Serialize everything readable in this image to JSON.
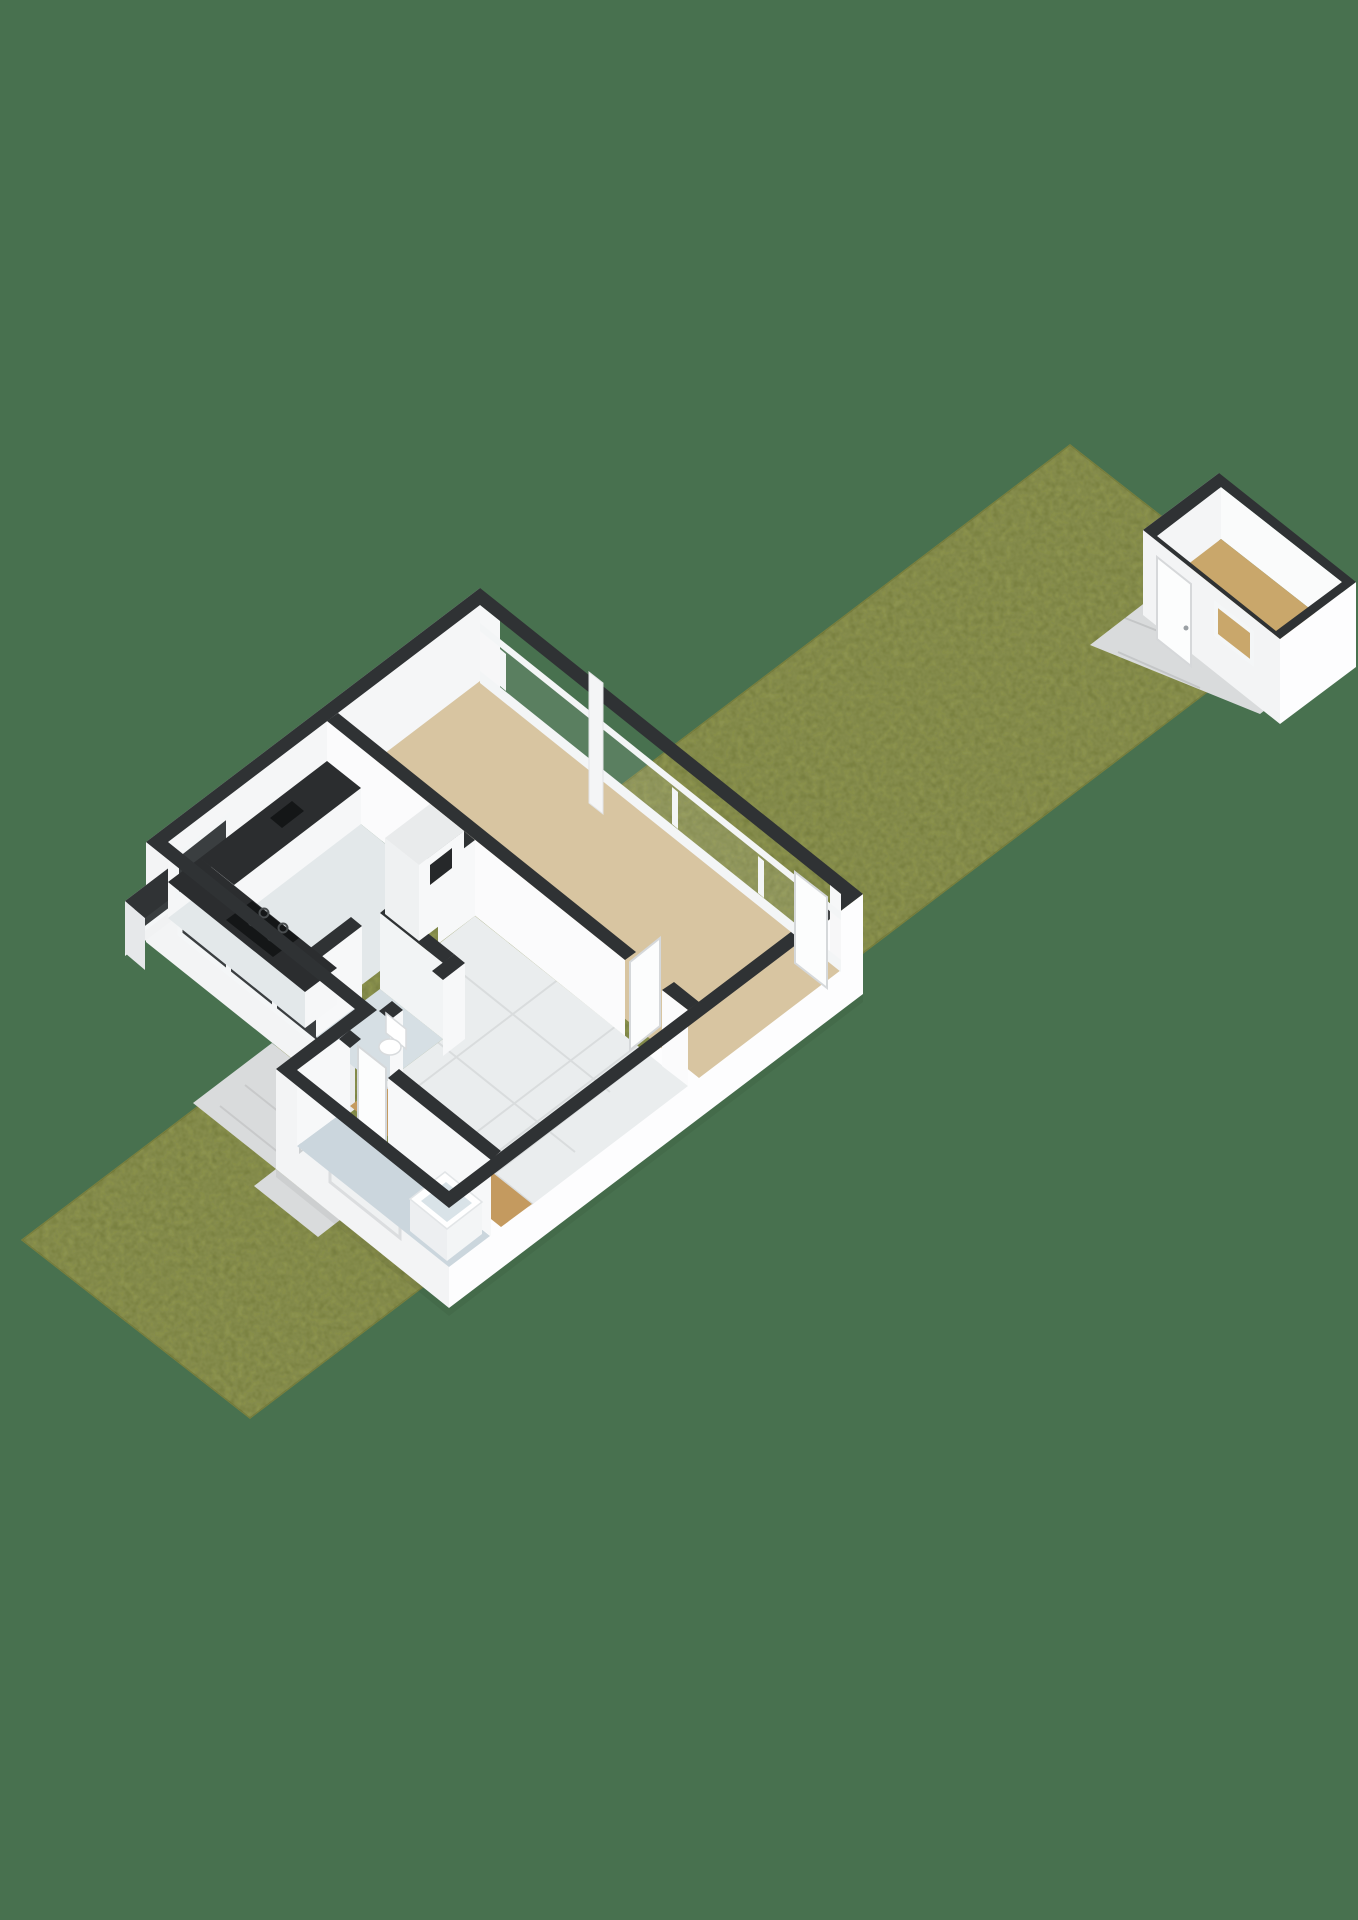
{
  "meta": {
    "kind": "3d-floorplan-render",
    "description": "Isometric 3D cutaway floor plan of a single-storey dwelling on a long narrow garden strip with a detached storage shed at the far end",
    "visible_text": []
  },
  "colors": {
    "background": "#48714F",
    "lawn": "#8C9350",
    "lawn_speckle": "#535B24",
    "lawn_edge": "#7A8140",
    "wall_top": "#2F3234",
    "wall_se": "#FDFDFE",
    "wall_sw": "#F3F4F5",
    "wall_nw": "#E8EAEC",
    "wall_inner": "#F5F6F7",
    "floor_living": "#D8C5A1",
    "floor_kitchen": "#E3E8EA",
    "floor_hall": "#EAEDEE",
    "floor_wood": "#C49A5F",
    "floor_bath": "#CBD6DD",
    "floor_toilet": "#D6DFE4",
    "counter_top": "#2B2D2F",
    "hob": "#141617",
    "cabinet": "#F6F7F8",
    "glass_dark": "#3A3E40",
    "frame": "#F3F5F6",
    "paving": "#D9DBDC",
    "shed_floor": "#C9A76B",
    "tub_rim": "#FFFFFF",
    "tub_inner": "#D9E3E8",
    "door_panel": "#FCFDFD",
    "door_edge": "#D5D8DA"
  },
  "scene": {
    "garden": {
      "name": "garden lawn strip"
    },
    "walkway": {
      "name": "entrance walkway tiles"
    },
    "main_building": {
      "rooms": [
        {
          "id": "living-room",
          "floor": "tan laminate"
        },
        {
          "id": "kitchen",
          "floor": "light vinyl",
          "features": [
            "L-shaped counter",
            "gas hob",
            "sink",
            "tall cabinet"
          ]
        },
        {
          "id": "hallway",
          "floor": "light tiles"
        },
        {
          "id": "toilet-room",
          "features": [
            "toilet"
          ]
        },
        {
          "id": "inner-hall",
          "floor": "wood"
        },
        {
          "id": "bathroom",
          "floor": "pale blue vinyl",
          "features": [
            "bathtub"
          ]
        }
      ],
      "windows": [
        "panoramic garden-facing window band",
        "kitchen front window",
        "corner bay window"
      ],
      "doors": [
        "garden door (open)",
        "living room door (open)",
        "front door",
        "bathroom door (open)"
      ]
    },
    "shed": {
      "id": "storage-shed",
      "features": [
        "door",
        "window",
        "wooden floor",
        "paved terrace"
      ]
    }
  }
}
